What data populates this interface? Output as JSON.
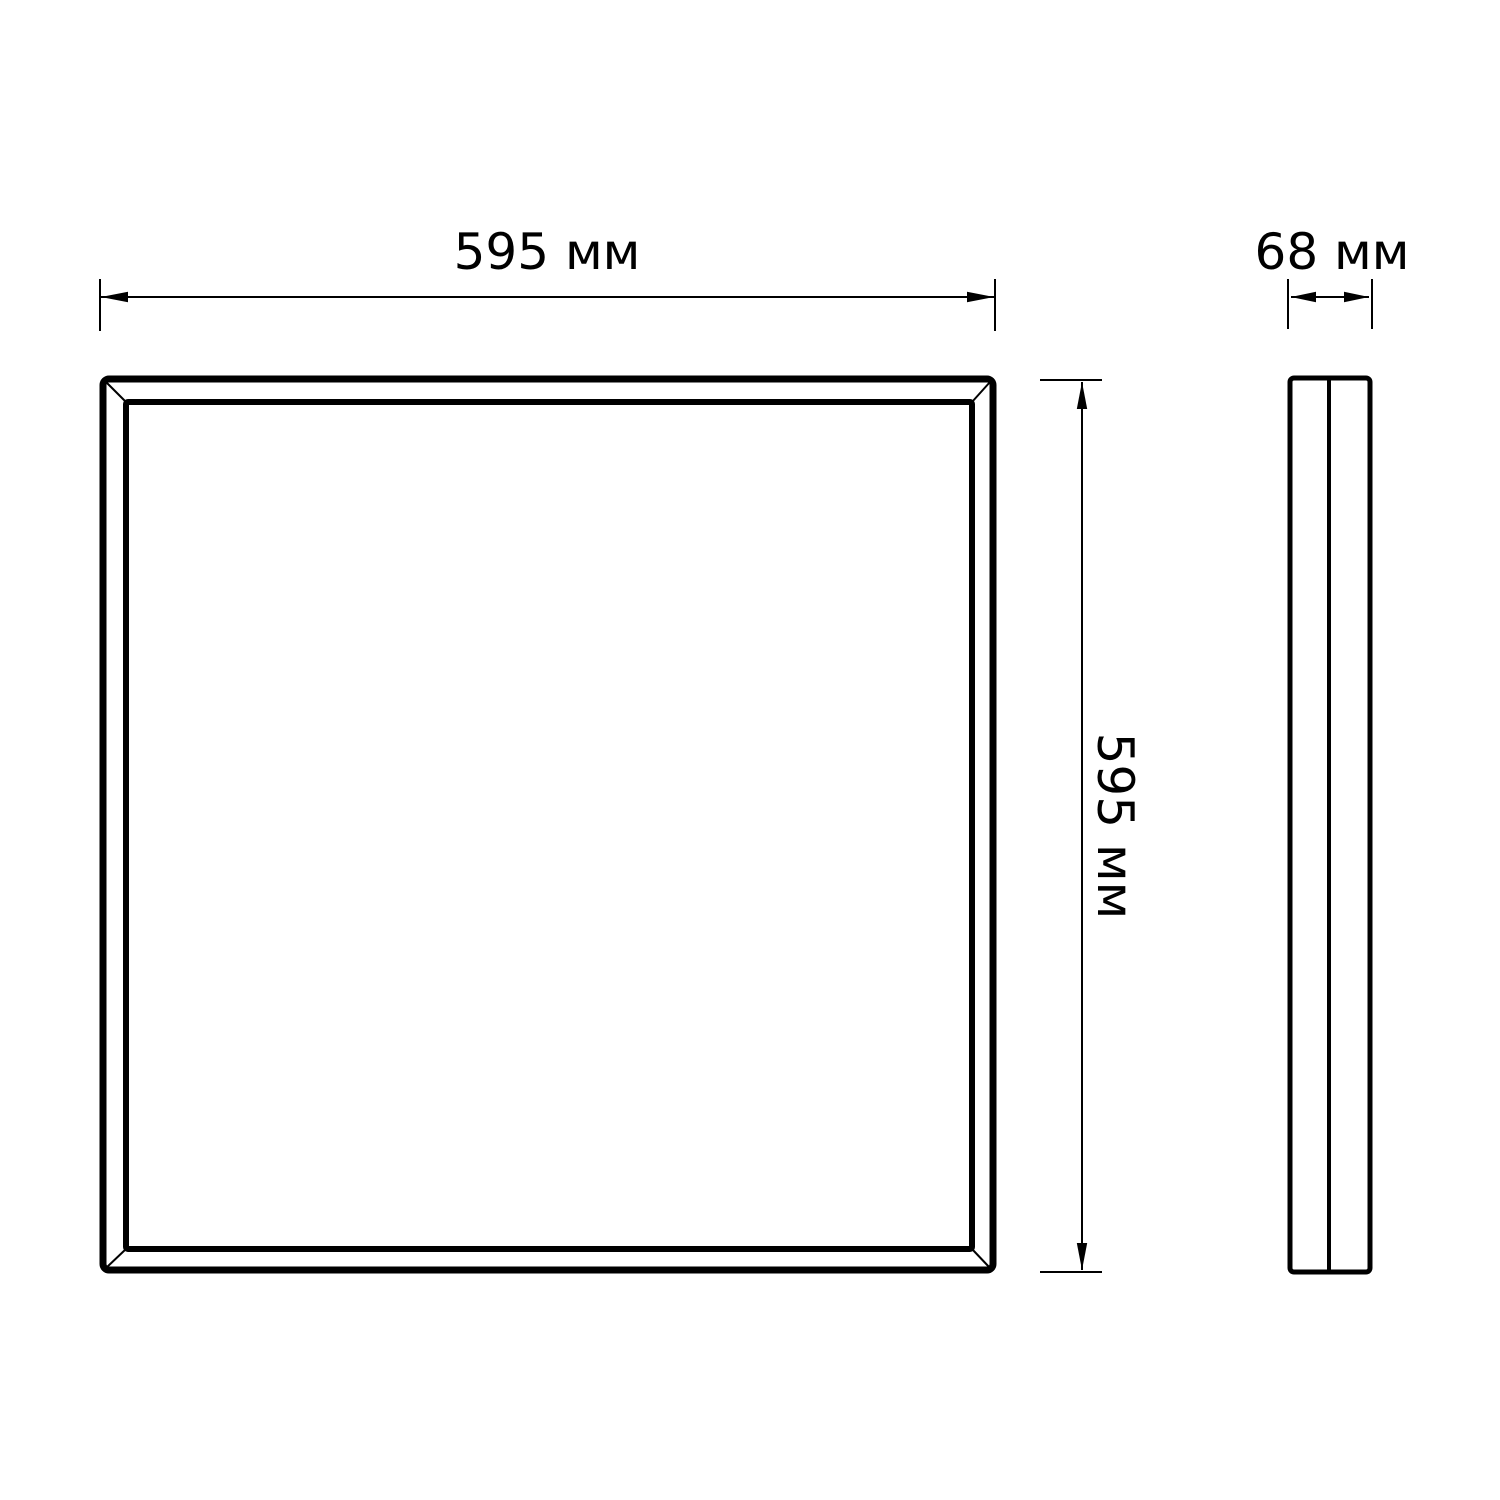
{
  "dimensions": {
    "width": {
      "value": "595",
      "unit": "мм",
      "label": "595 мм"
    },
    "height": {
      "value": "595",
      "unit": "мм",
      "label": "595 мм"
    },
    "depth": {
      "value": "68",
      "unit": "мм",
      "label": "68 мм"
    }
  },
  "colors": {
    "line": "#000000",
    "background": "#ffffff"
  }
}
